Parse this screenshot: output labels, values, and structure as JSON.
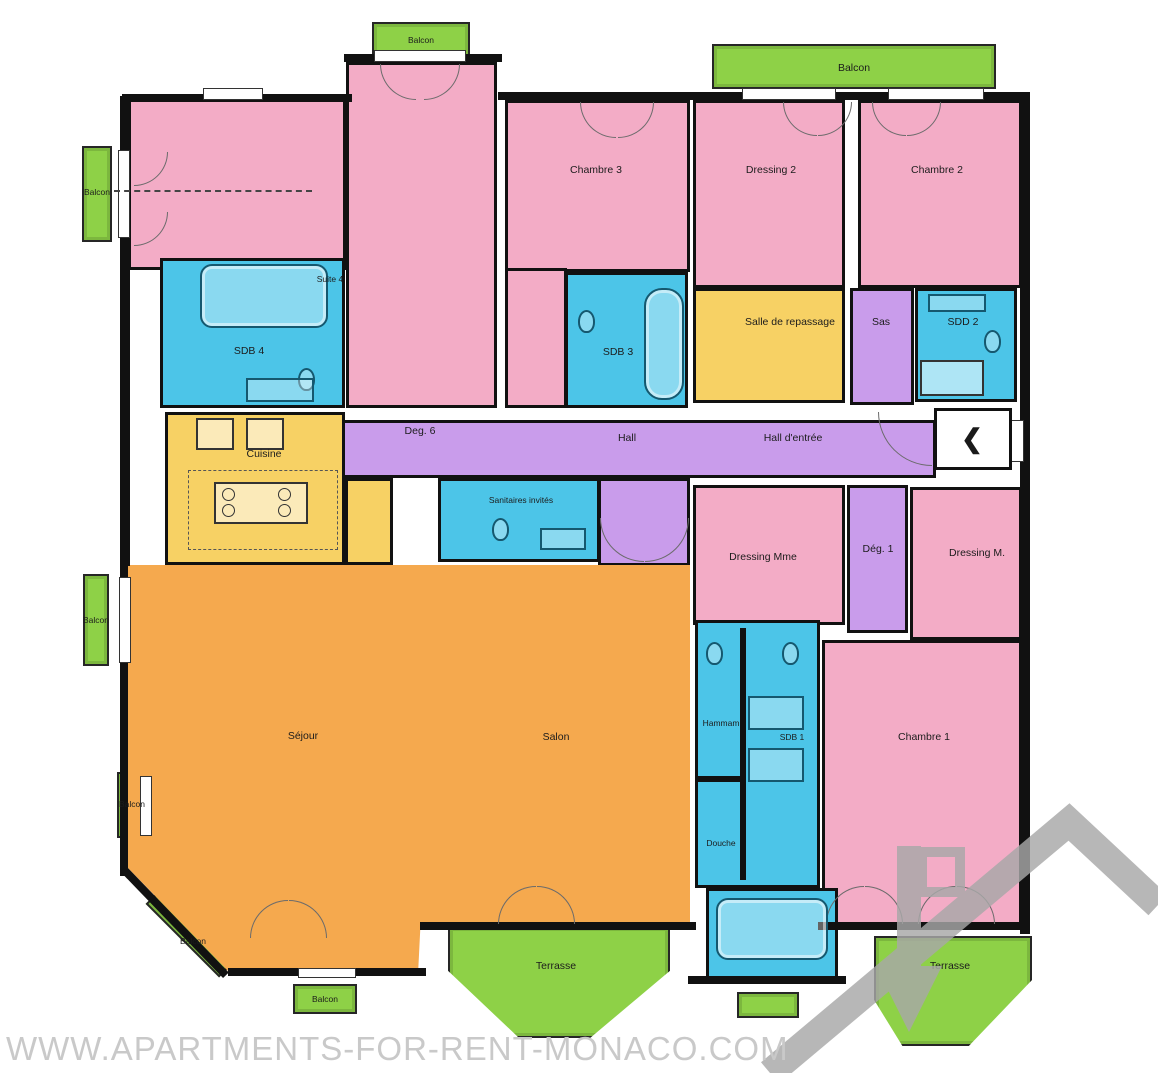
{
  "labels": {
    "balcon": "Balcon",
    "terrasse": "Terrasse",
    "suite4": "Suite 4",
    "chambre3": "Chambre 3",
    "dressing2": "Dressing 2",
    "chambre2": "Chambre 2",
    "sdb4": "SDB 4",
    "sdb3": "SDB 3",
    "salle_de_repassage": "Salle de repassage",
    "sas": "Sas",
    "sdd2": "SDD 2",
    "deg6": "Deg. 6",
    "hall": "Hall",
    "hall_entree": "Hall d'entrée",
    "cuisine": "Cuisine",
    "sanitaires_invites": "Sanitaires invités",
    "dressing_mme": "Dressing Mme",
    "deg1": "Dég. 1",
    "dressing_m": "Dressing M.",
    "sejour": "Séjour",
    "salon": "Salon",
    "hammam": "Hammam",
    "sdb1": "SDB 1",
    "chambre1": "Chambre 1",
    "douche": "Douche"
  },
  "entrance": {
    "chevron": "❮"
  },
  "watermark": {
    "text": "WWW.APARTMENTS-FOR-RENT-MONACO.COM"
  },
  "colors": {
    "bedroom_pink": "#f3acc6",
    "bath_blue": "#4cc5e8",
    "service_yellow": "#f7d164",
    "hall_purple": "#c99ceb",
    "living_orange": "#f5a94e",
    "outdoor_green": "#8ed147",
    "wall_black": "#111111",
    "watermark_gray": "#c9c9c9",
    "logo_gray": "#a8a8a8"
  }
}
